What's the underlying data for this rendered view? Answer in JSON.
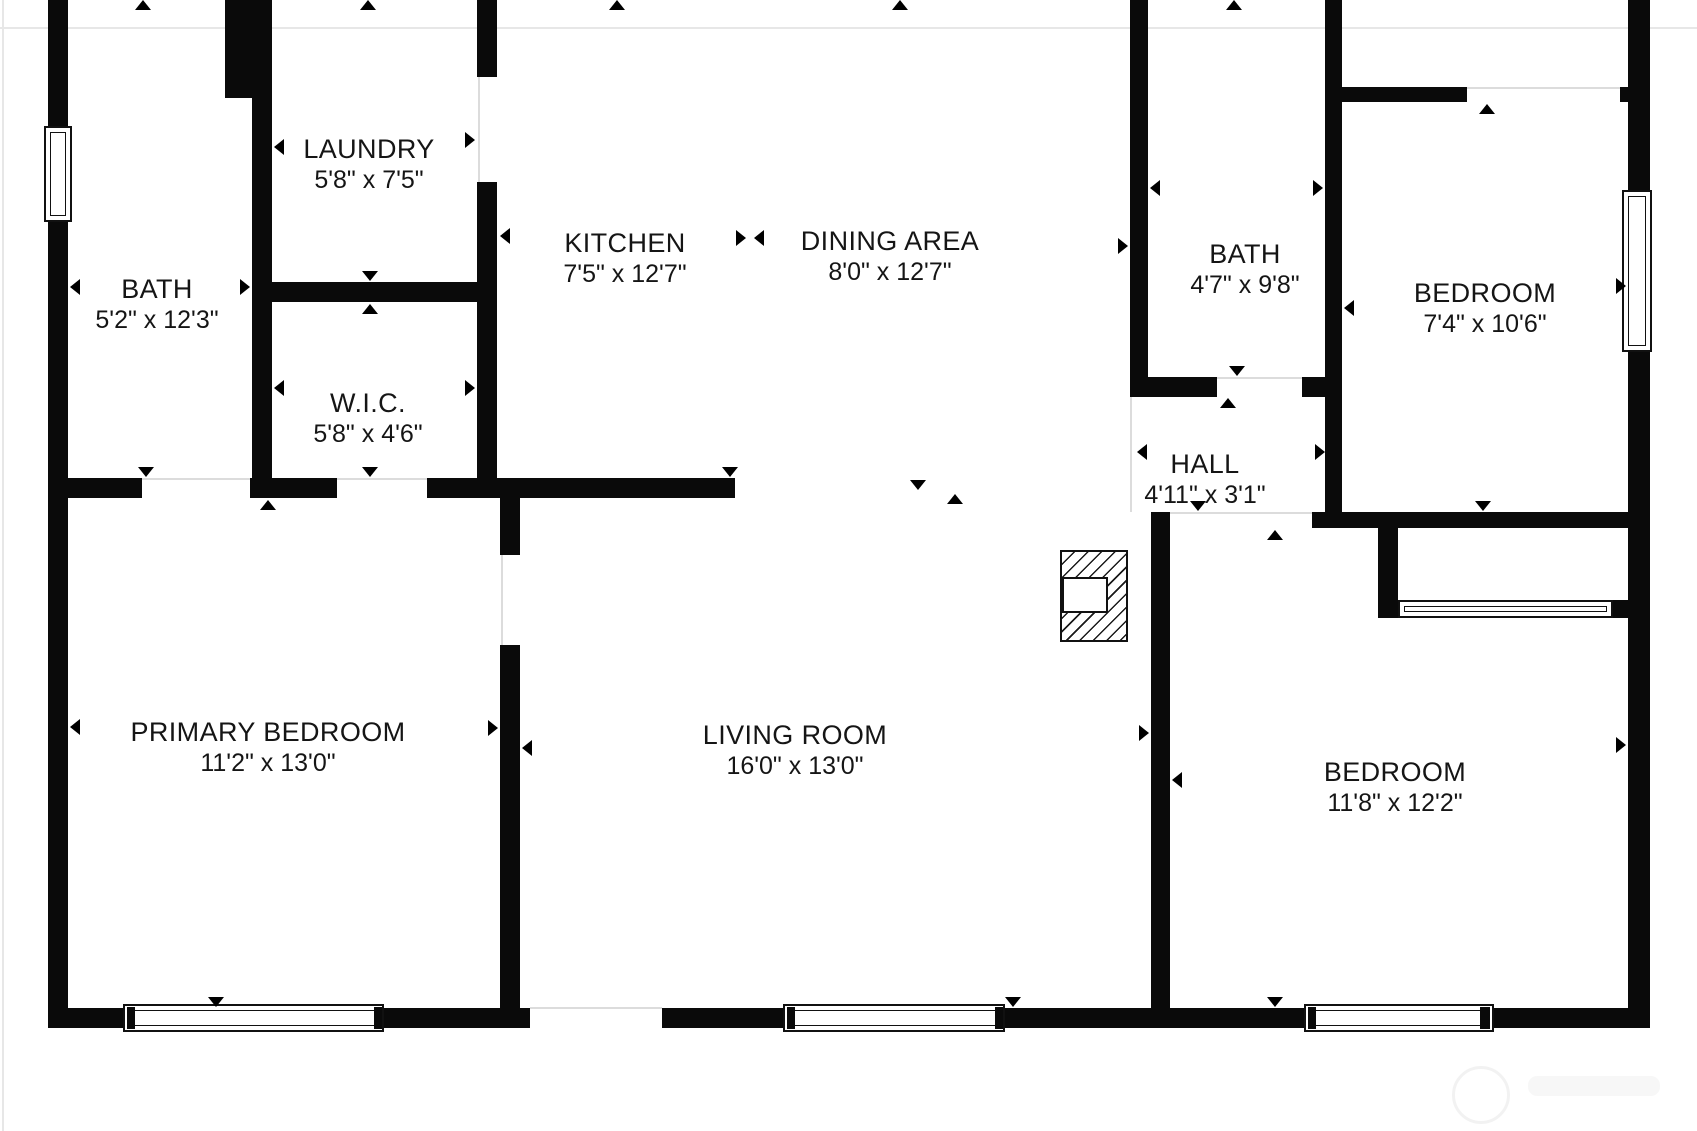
{
  "plan": {
    "canvas": {
      "width": 1697,
      "height": 1131,
      "background": "#ffffff"
    },
    "colors": {
      "wall": "#0a0a0a",
      "text": "#151515",
      "threshold": "#dcdcdc",
      "cropline": "#e7e7e7",
      "watermark": "rgba(0,0,0,0.05)"
    },
    "rooms": [
      {
        "id": "bath-left",
        "name": "BATH",
        "dims": "5'2\" x 12'3\"",
        "cx": 157,
        "cy": 305
      },
      {
        "id": "laundry",
        "name": "LAUNDRY",
        "dims": "5'8\" x 7'5\"",
        "cx": 369,
        "cy": 165
      },
      {
        "id": "wic",
        "name": "W.I.C.",
        "dims": "5'8\" x 4'6\"",
        "cx": 368,
        "cy": 419
      },
      {
        "id": "kitchen",
        "name": "KITCHEN",
        "dims": "7'5\" x 12'7\"",
        "cx": 625,
        "cy": 259
      },
      {
        "id": "dining-area",
        "name": "DINING AREA",
        "dims": "8'0\" x 12'7\"",
        "cx": 890,
        "cy": 257
      },
      {
        "id": "bath-right",
        "name": "BATH",
        "dims": "4'7\" x 9'8\"",
        "cx": 1245,
        "cy": 270
      },
      {
        "id": "bedroom-top",
        "name": "BEDROOM",
        "dims": "7'4\" x 10'6\"",
        "cx": 1485,
        "cy": 309
      },
      {
        "id": "hall",
        "name": "HALL",
        "dims": "4'11\" x 3'1\"",
        "cx": 1205,
        "cy": 480
      },
      {
        "id": "primary-bedroom",
        "name": "PRIMARY BEDROOM",
        "dims": "11'2\" x 13'0\"",
        "cx": 268,
        "cy": 748
      },
      {
        "id": "living-room",
        "name": "LIVING ROOM",
        "dims": "16'0\" x 13'0\"",
        "cx": 795,
        "cy": 751
      },
      {
        "id": "bedroom-bottom",
        "name": "BEDROOM",
        "dims": "11'8\" x 12'2\"",
        "cx": 1395,
        "cy": 788
      }
    ],
    "walls": [
      [
        48,
        0,
        20,
        128
      ],
      [
        48,
        222,
        20,
        806
      ],
      [
        48,
        1008,
        77,
        20
      ],
      [
        382,
        1008,
        148,
        20
      ],
      [
        662,
        1008,
        123,
        20
      ],
      [
        1003,
        1008,
        303,
        20
      ],
      [
        1492,
        1008,
        158,
        20
      ],
      [
        1628,
        0,
        22,
        192
      ],
      [
        1628,
        350,
        22,
        678
      ],
      [
        225,
        0,
        47,
        98
      ],
      [
        252,
        98,
        20,
        184
      ],
      [
        252,
        282,
        245,
        20
      ],
      [
        252,
        302,
        20,
        176
      ],
      [
        477,
        0,
        20,
        77
      ],
      [
        477,
        182,
        20,
        296
      ],
      [
        48,
        478,
        94,
        20
      ],
      [
        250,
        478,
        87,
        20
      ],
      [
        427,
        478,
        308,
        20
      ],
      [
        500,
        498,
        20,
        57
      ],
      [
        500,
        645,
        20,
        363
      ],
      [
        1130,
        0,
        18,
        397
      ],
      [
        1130,
        377,
        87,
        20
      ],
      [
        1302,
        377,
        23,
        20
      ],
      [
        1325,
        0,
        17,
        512
      ],
      [
        1342,
        87,
        125,
        15
      ],
      [
        1620,
        87,
        8,
        15
      ],
      [
        1312,
        512,
        318,
        16
      ],
      [
        1325,
        504,
        15,
        8
      ],
      [
        1151,
        512,
        19,
        496
      ],
      [
        1378,
        528,
        20,
        90
      ],
      [
        1378,
        600,
        22,
        18
      ],
      [
        1613,
        600,
        15,
        18
      ]
    ],
    "windows": [
      {
        "x": 44,
        "y": 126,
        "w": 28,
        "h": 96
      },
      {
        "x": 1622,
        "y": 190,
        "w": 30,
        "h": 162
      },
      {
        "x": 123,
        "y": 1004,
        "w": 261,
        "h": 28
      },
      {
        "x": 783,
        "y": 1004,
        "w": 222,
        "h": 28
      },
      {
        "x": 1304,
        "y": 1004,
        "w": 190,
        "h": 28
      },
      {
        "x": 1398,
        "y": 600,
        "w": 215,
        "h": 18
      }
    ],
    "jambs": [
      [
        127,
        1007,
        8,
        22
      ],
      [
        374,
        1007,
        8,
        22
      ],
      [
        787,
        1007,
        8,
        22
      ],
      [
        995,
        1007,
        8,
        22
      ],
      [
        1308,
        1007,
        8,
        22
      ],
      [
        1480,
        1007,
        10,
        22
      ]
    ],
    "thresholds": [
      [
        142,
        478,
        108,
        2
      ],
      [
        337,
        478,
        90,
        2
      ],
      [
        478,
        77,
        2,
        105
      ],
      [
        501,
        555,
        2,
        90
      ],
      [
        1217,
        377,
        85,
        2
      ],
      [
        1170,
        512,
        142,
        2
      ],
      [
        1467,
        87,
        153,
        2
      ],
      [
        530,
        1007,
        132,
        2
      ],
      [
        1130,
        397,
        2,
        115
      ]
    ],
    "croplines": [
      [
        0,
        27,
        1697,
        2
      ],
      [
        2,
        0,
        2,
        1131
      ]
    ],
    "markers": {
      "up": [
        [
          143,
          0
        ],
        [
          368,
          0
        ],
        [
          617,
          0
        ],
        [
          900,
          0
        ],
        [
          1234,
          0
        ],
        [
          370,
          304
        ],
        [
          268,
          500
        ],
        [
          955,
          494
        ],
        [
          1228,
          398
        ],
        [
          1487,
          104
        ],
        [
          1275,
          530
        ]
      ],
      "down": [
        [
          146,
          477
        ],
        [
          370,
          281
        ],
        [
          370,
          477
        ],
        [
          730,
          477
        ],
        [
          918,
          490
        ],
        [
          1237,
          376
        ],
        [
          1198,
          511
        ],
        [
          1483,
          511
        ],
        [
          216,
          1007
        ],
        [
          1013,
          1007
        ],
        [
          1275,
          1007
        ]
      ],
      "left": [
        [
          70,
          287
        ],
        [
          274,
          147
        ],
        [
          274,
          388
        ],
        [
          500,
          236
        ],
        [
          754,
          238
        ],
        [
          1150,
          188
        ],
        [
          1344,
          308
        ],
        [
          1137,
          452
        ],
        [
          70,
          727
        ],
        [
          522,
          748
        ],
        [
          1172,
          780
        ]
      ],
      "right": [
        [
          250,
          287
        ],
        [
          475,
          140
        ],
        [
          475,
          388
        ],
        [
          746,
          238
        ],
        [
          1128,
          246
        ],
        [
          1323,
          188
        ],
        [
          1626,
          286
        ],
        [
          1325,
          452
        ],
        [
          498,
          728
        ],
        [
          1149,
          733
        ],
        [
          1626,
          745
        ]
      ]
    },
    "fireplace": {
      "x": 1060,
      "y": 550,
      "w": 68,
      "h": 92,
      "inner": {
        "x": 1062,
        "y": 577,
        "w": 46,
        "h": 36
      }
    },
    "watermark": {
      "circle": {
        "x": 1452,
        "y": 1066,
        "w": 52,
        "h": 52
      },
      "blob": {
        "x": 1528,
        "y": 1076,
        "w": 132,
        "h": 20
      }
    }
  }
}
